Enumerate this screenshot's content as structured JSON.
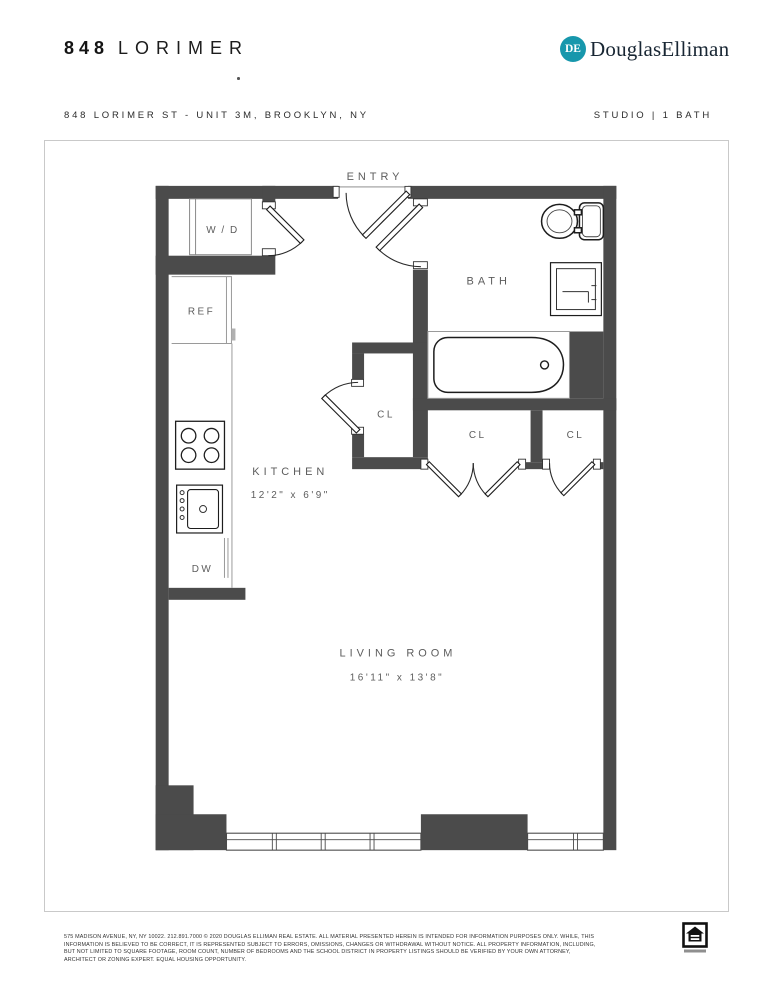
{
  "header": {
    "building_number": "848",
    "building_name": "LORIMER",
    "brand": {
      "monogram": "DE",
      "name": "DouglasElliman",
      "accent_color": "#1797ac"
    },
    "address": "848 LORIMER ST - UNIT 3M, BROOKLYN, NY",
    "unit_summary": "STUDIO | 1 BATH"
  },
  "floor_plan": {
    "wall_color": "#4b4b4b",
    "labels": {
      "entry": "ENTRY",
      "bath": "BATH",
      "washer_dryer": "W / D",
      "refrigerator": "REF",
      "kitchen": "KITCHEN",
      "kitchen_dimensions": "12'2\" x 6'9\"",
      "dishwasher": "DW",
      "closet_kitchen": "CL",
      "closet_middle": "CL",
      "closet_right": "CL",
      "living_room": "LIVING ROOM",
      "living_room_dimensions": "16'11\" x 13'8\""
    }
  },
  "footer": {
    "line1": "575 MADISON AVENUE, NY, NY 10022. 212.891.7000 © 2020 DOUGLAS ELLIMAN REAL ESTATE. ALL MATERIAL PRESENTED HEREIN IS INTENDED FOR INFORMATION PURPOSES ONLY. WHILE, THIS",
    "line2": "INFORMATION IS BELIEVED TO BE CORRECT, IT IS REPRESENTED SUBJECT TO ERRORS, OMISSIONS, CHANGES OR WITHDRAWAL WITHOUT NOTICE. ALL PROPERTY INFORMATION, INCLUDING,",
    "line3": "BUT NOT LIMITED TO SQUARE FOOTAGE, ROOM COUNT, NUMBER OF BEDROOMS AND THE SCHOOL DISTRICT IN PROPERTY LISTINGS SHOULD BE VERIFIED BY YOUR OWN ATTORNEY,",
    "line4": "ARCHITECT OR ZONING EXPERT. EQUAL HOUSING OPPORTUNITY.",
    "equal_housing_icon": "equal-housing-opportunity"
  }
}
